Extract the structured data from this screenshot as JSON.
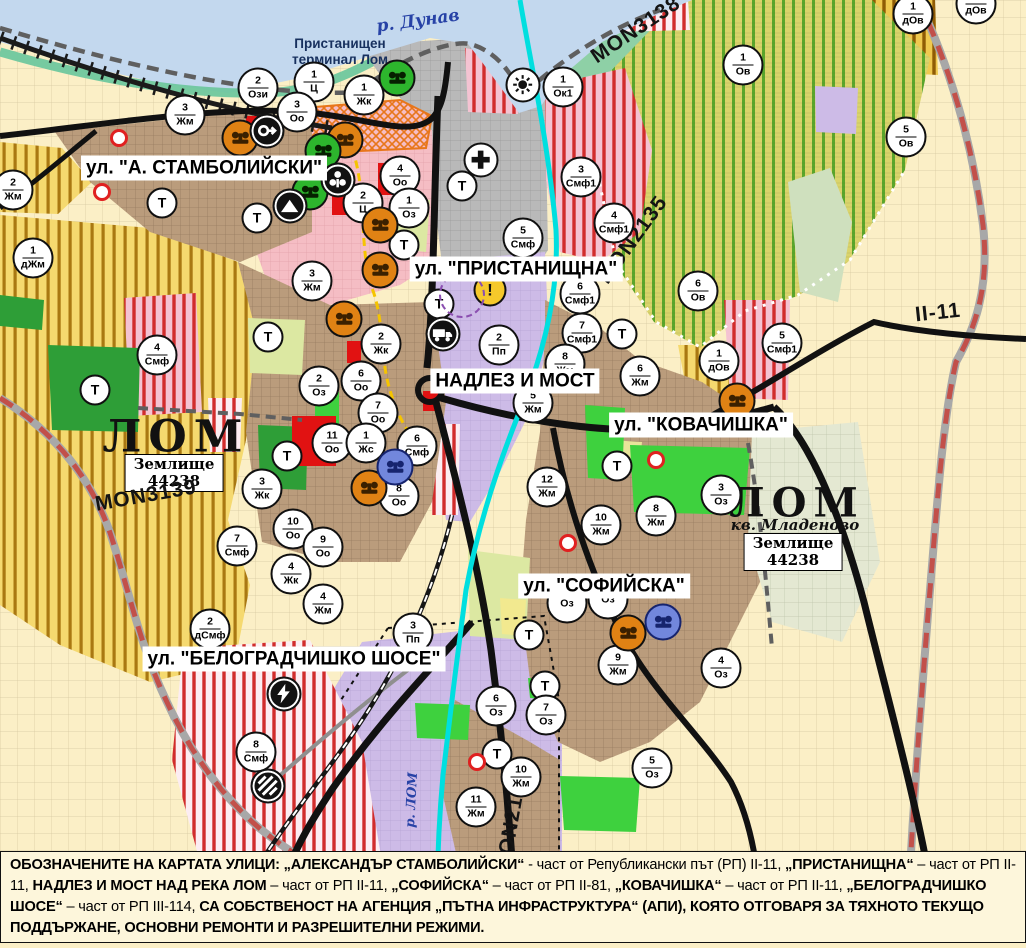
{
  "colors": {
    "water": "#C3D8EE",
    "shore_green": "#6FC79E",
    "port_grey": "#B9B9B9",
    "city_pink": "#F5BDC4",
    "urban_brown": "#BA9C7C",
    "industrial_purple": "#CDBBE7",
    "fields_cream": "#FBEFC6",
    "farm_yellow": "#F5D96F",
    "farm_stripe": "#A97812",
    "vineyard_yellow": "#DAD46B",
    "vineyard_stripe": "#5AA72B",
    "smf_stripe_red": "#D12C2C",
    "park_green": "#2E9E37",
    "city_green": "#3ED13E",
    "pale_green": "#DCE8A2",
    "river_cyan": "#00DFDF",
    "road_black": "#111111",
    "road_red_dashed": "#C2504A",
    "boundary_grey": "#5F5F5F",
    "marker_orange": "#E08214",
    "marker_green": "#2DB52D",
    "marker_blue": "#7287DC",
    "warning_yellow": "#F6C92B",
    "label_navy": "#17305E",
    "danube_blue": "#2742A6",
    "caption_bg": "#FDF6DB",
    "red_zone": "#E11212"
  },
  "map_labels": {
    "river_danube": "р. Дунав",
    "port_terminal_line1": "Пристанищен",
    "port_terminal_line2": "терминал Лом",
    "city_left": "ЛОМ",
    "city_right": "ЛОМ",
    "district_right": "кв. Младеново",
    "landplot_line1": "Землище",
    "landplot_line2": "44238",
    "river_lom": "р. ЛОМ"
  },
  "street_labels": [
    {
      "text": "ул. \"А. СТАМБОЛИЙСКИ\"",
      "x": 204,
      "y": 168
    },
    {
      "text": "ул. \"ПРИСТАНИЩНА\"",
      "x": 516,
      "y": 269
    },
    {
      "text": "НАДЛЕЗ И МОСТ",
      "x": 515,
      "y": 381
    },
    {
      "text": "ул. \"КОВАЧИШКА\"",
      "x": 701,
      "y": 425
    },
    {
      "text": "ул. \"СОФИЙСКА\"",
      "x": 604,
      "y": 586
    },
    {
      "text": "ул. \"БЕЛОГРАДЧИШКО ШОСЕ\"",
      "x": 294,
      "y": 659
    }
  ],
  "road_labels": [
    {
      "text": "MON3139",
      "x": 146,
      "y": 496,
      "rotate": -10
    },
    {
      "text": "MON3138",
      "x": 636,
      "y": 30,
      "rotate": -34
    },
    {
      "text": "MON2135",
      "x": 633,
      "y": 240,
      "rotate": -54
    },
    {
      "text": "MON2136",
      "x": 512,
      "y": 822,
      "rotate": -80
    },
    {
      "text": "II-11",
      "x": 938,
      "y": 313,
      "rotate": -6
    }
  ],
  "markers": [
    {
      "n": "3",
      "d": "Жм",
      "x": 185,
      "y": 115
    },
    {
      "n": "2",
      "d": "Ози",
      "x": 258,
      "y": 88
    },
    {
      "n": "1",
      "d": "Ц",
      "x": 314,
      "y": 82
    },
    {
      "n": "3",
      "d": "Оо",
      "x": 297,
      "y": 112
    },
    {
      "n": "1",
      "d": "Жк",
      "x": 364,
      "y": 95
    },
    {
      "n": "1",
      "d": "Ок1",
      "x": 563,
      "y": 87
    },
    {
      "n": "1",
      "d": "Ов",
      "x": 743,
      "y": 65
    },
    {
      "n": "1",
      "d": "дОв",
      "x": 913,
      "y": 14
    },
    {
      "n": "1",
      "d": "дОв",
      "x": 976,
      "y": 4
    },
    {
      "n": "5",
      "d": "Ов",
      "x": 906,
      "y": 137
    },
    {
      "n": "2",
      "d": "Жм",
      "x": 13,
      "y": 190
    },
    {
      "n": "Т",
      "d": "",
      "x": 162,
      "y": 203
    },
    {
      "n": "Т",
      "d": "",
      "x": 257,
      "y": 218
    },
    {
      "n": "1",
      "d": "дЖм",
      "x": 33,
      "y": 258
    },
    {
      "n": "3",
      "d": "Жм",
      "x": 312,
      "y": 281
    },
    {
      "n": "4",
      "d": "Оо",
      "x": 400,
      "y": 176
    },
    {
      "n": "2",
      "d": "Ц",
      "x": 363,
      "y": 203
    },
    {
      "n": "1",
      "d": "Оз",
      "x": 409,
      "y": 208
    },
    {
      "n": "Т",
      "d": "",
      "x": 404,
      "y": 245
    },
    {
      "n": "Т",
      "d": "",
      "x": 462,
      "y": 186
    },
    {
      "n": "3",
      "d": "Смф1",
      "x": 581,
      "y": 177
    },
    {
      "n": "4",
      "d": "Смф1",
      "x": 614,
      "y": 223
    },
    {
      "n": "5",
      "d": "Смф",
      "x": 523,
      "y": 238
    },
    {
      "n": "6",
      "d": "Смф1",
      "x": 580,
      "y": 294
    },
    {
      "n": "7",
      "d": "Смф1",
      "x": 582,
      "y": 333
    },
    {
      "n": "Т",
      "d": "",
      "x": 622,
      "y": 334
    },
    {
      "n": "6",
      "d": "Ов",
      "x": 698,
      "y": 291
    },
    {
      "n": "1",
      "d": "дОв",
      "x": 719,
      "y": 361
    },
    {
      "n": "5",
      "d": "Смф1",
      "x": 782,
      "y": 343
    },
    {
      "n": "Т",
      "d": "",
      "x": 439,
      "y": 304
    },
    {
      "n": "2",
      "d": "Пп",
      "x": 499,
      "y": 345
    },
    {
      "n": "8",
      "d": "Жм",
      "x": 565,
      "y": 364
    },
    {
      "n": "5",
      "d": "Жм",
      "x": 533,
      "y": 403
    },
    {
      "n": "6",
      "d": "Жм",
      "x": 640,
      "y": 376
    },
    {
      "n": "4",
      "d": "Смф",
      "x": 157,
      "y": 355
    },
    {
      "n": "Т",
      "d": "",
      "x": 95,
      "y": 390
    },
    {
      "n": "Т",
      "d": "",
      "x": 268,
      "y": 337
    },
    {
      "n": "2",
      "d": "Оз",
      "x": 319,
      "y": 386
    },
    {
      "n": "2",
      "d": "Жк",
      "x": 381,
      "y": 344
    },
    {
      "n": "6",
      "d": "Оо",
      "x": 361,
      "y": 381
    },
    {
      "n": "7",
      "d": "Оо",
      "x": 378,
      "y": 413
    },
    {
      "n": "11",
      "d": "Оо",
      "x": 332,
      "y": 443
    },
    {
      "n": "1",
      "d": "Жс",
      "x": 366,
      "y": 443
    },
    {
      "n": "6",
      "d": "Смф",
      "x": 417,
      "y": 446
    },
    {
      "n": "Т",
      "d": "",
      "x": 287,
      "y": 456
    },
    {
      "n": "8",
      "d": "Оо",
      "x": 399,
      "y": 496
    },
    {
      "n": "3",
      "d": "Жк",
      "x": 262,
      "y": 489
    },
    {
      "n": "12",
      "d": "Жм",
      "x": 547,
      "y": 487
    },
    {
      "n": "Т",
      "d": "",
      "x": 617,
      "y": 466
    },
    {
      "n": "10",
      "d": "Жм",
      "x": 601,
      "y": 525
    },
    {
      "n": "8",
      "d": "Жм",
      "x": 656,
      "y": 516
    },
    {
      "n": "3",
      "d": "Оз",
      "x": 721,
      "y": 495
    },
    {
      "n": "7",
      "d": "Смф",
      "x": 237,
      "y": 546
    },
    {
      "n": "10",
      "d": "Оо",
      "x": 293,
      "y": 529
    },
    {
      "n": "9",
      "d": "Оо",
      "x": 323,
      "y": 547
    },
    {
      "n": "4",
      "d": "Жк",
      "x": 291,
      "y": 574
    },
    {
      "n": "4",
      "d": "Жм",
      "x": 323,
      "y": 604
    },
    {
      "n": "2",
      "d": "дСмф",
      "x": 210,
      "y": 629
    },
    {
      "n": "3",
      "d": "Пп",
      "x": 413,
      "y": 633
    },
    {
      "n": "8",
      "d": "Смф",
      "x": 256,
      "y": 752
    },
    {
      "n": "",
      "d": "Оз",
      "x": 567,
      "y": 603
    },
    {
      "n": "",
      "d": "Оз",
      "x": 608,
      "y": 599
    },
    {
      "n": "9",
      "d": "Жм",
      "x": 618,
      "y": 665
    },
    {
      "n": "4",
      "d": "Оз",
      "x": 721,
      "y": 668
    },
    {
      "n": "Т",
      "d": "",
      "x": 529,
      "y": 635
    },
    {
      "n": "Т",
      "d": "",
      "x": 545,
      "y": 686
    },
    {
      "n": "6",
      "d": "Оз",
      "x": 496,
      "y": 706
    },
    {
      "n": "7",
      "d": "Оз",
      "x": 546,
      "y": 715
    },
    {
      "n": "Т",
      "d": "",
      "x": 497,
      "y": 754
    },
    {
      "n": "10",
      "d": "Жм",
      "x": 521,
      "y": 777
    },
    {
      "n": "11",
      "d": "Жм",
      "x": 476,
      "y": 807
    },
    {
      "n": "5",
      "d": "Оз",
      "x": 652,
      "y": 768
    }
  ],
  "icon_markers": [
    {
      "type": "monument-orange",
      "x": 240,
      "y": 138
    },
    {
      "type": "monument-orange",
      "x": 345,
      "y": 140
    },
    {
      "type": "monument-orange",
      "x": 380,
      "y": 225
    },
    {
      "type": "monument-orange",
      "x": 380,
      "y": 270
    },
    {
      "type": "monument-orange",
      "x": 344,
      "y": 319
    },
    {
      "type": "monument-orange",
      "x": 369,
      "y": 488
    },
    {
      "type": "monument-orange",
      "x": 628,
      "y": 633
    },
    {
      "type": "monument-orange",
      "x": 737,
      "y": 401
    },
    {
      "type": "monument-green",
      "x": 397,
      "y": 78
    },
    {
      "type": "monument-green",
      "x": 323,
      "y": 151
    },
    {
      "type": "monument-green",
      "x": 310,
      "y": 192
    },
    {
      "type": "monument-blue",
      "x": 395,
      "y": 467
    },
    {
      "type": "monument-blue",
      "x": 663,
      "y": 622
    },
    {
      "type": "circle-arrow",
      "x": 267,
      "y": 131
    },
    {
      "type": "person",
      "x": 338,
      "y": 180
    },
    {
      "type": "mountain",
      "x": 290,
      "y": 206
    },
    {
      "type": "truck",
      "x": 443,
      "y": 334
    },
    {
      "type": "lightning",
      "x": 284,
      "y": 694
    },
    {
      "type": "railway-crossing",
      "x": 268,
      "y": 786
    },
    {
      "type": "sun",
      "x": 523,
      "y": 85
    },
    {
      "type": "cross",
      "x": 481,
      "y": 160
    },
    {
      "type": "warning",
      "x": 490,
      "y": 290
    },
    {
      "type": "dashed-ring",
      "x": 462,
      "y": 295
    },
    {
      "type": "red-dot",
      "x": 119,
      "y": 138
    },
    {
      "type": "red-dot",
      "x": 102,
      "y": 192
    },
    {
      "type": "red-dot",
      "x": 656,
      "y": 460
    },
    {
      "type": "red-dot",
      "x": 568,
      "y": 543
    },
    {
      "type": "red-dot",
      "x": 477,
      "y": 762
    }
  ],
  "caption": {
    "segments": [
      {
        "text": "ОБОЗНАЧЕНИТЕ НА КАРТАТА УЛИЦИ: „АЛЕКСАНДЪР СТАМБОЛИЙСКИ“",
        "bold": true
      },
      {
        "text": " - част от Републикански път (РП) II-11, ",
        "bold": false
      },
      {
        "text": "„ПРИСТАНИЩНА“",
        "bold": true
      },
      {
        "text": " – част от РП II-11, ",
        "bold": false
      },
      {
        "text": "НАДЛЕЗ И МОСТ НАД РЕКА ЛОМ",
        "bold": true
      },
      {
        "text": " – част от РП II-11, ",
        "bold": false
      },
      {
        "text": "„СОФИЙСКА“",
        "bold": true
      },
      {
        "text": " – част от РП II-81, ",
        "bold": false
      },
      {
        "text": "„КОВАЧИШКА“",
        "bold": true
      },
      {
        "text": " – част от РП II-11, ",
        "bold": false
      },
      {
        "text": "„БЕЛОГРАДЧИШКО ШОСЕ“",
        "bold": true
      },
      {
        "text": " – част от РП III-114, ",
        "bold": false
      },
      {
        "text": "СА СОБСТВЕНОСТ НА АГЕНЦИЯ „ПЪТНА ИНФРАСТРУКТУРА“ (АПИ), КОЯТО ОТГОВАРЯ ЗА ТЯХНОТО ТЕКУЩО ПОДДЪРЖАНЕ, ОСНОВНИ РЕМОНТИ И РАЗРЕШИТЕЛНИ РЕЖИМИ.",
        "bold": true
      }
    ]
  }
}
